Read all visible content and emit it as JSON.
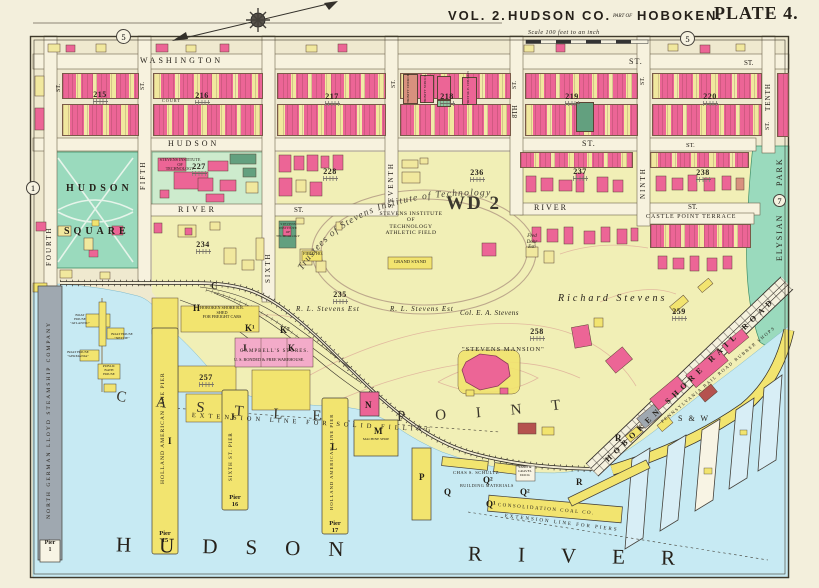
{
  "header": {
    "vol": "VOL. 2.",
    "county": "HUDSON CO.",
    "part_of": "PART OF",
    "city": "HOBOKEN.",
    "plate": "PLATE 4.",
    "scale": "Scale 100 feet to an inch"
  },
  "refs": {
    "top_left": "5",
    "top_right": "5",
    "left": "1",
    "right": "7"
  },
  "streets": {
    "washington": "WASHINGTON",
    "washington_st1": "ST.",
    "washington_st2": "ST.",
    "hudson": "HUDSON",
    "hudson_st1": "ST.",
    "hudson_st2": "ST.",
    "river_w": "RIVER",
    "river_w_st": "ST.",
    "river_e": "RIVER",
    "river_e_st": "ST.",
    "castle_point_terrace": "CASTLE POINT TERRACE",
    "fourth": "FOURTH",
    "fourth_st": "ST.",
    "fifth": "FIFTH",
    "fifth_st": "ST.",
    "sixth": "SIXTH",
    "seventh": "SEVENTH",
    "seventh_st": "ST.",
    "eighth": "8TH",
    "eighth_st": "ST.",
    "ninth": "NINTH",
    "ninth_st": "ST.",
    "tenth": "TENTH",
    "tenth_st": "ST.",
    "court": "COURT"
  },
  "areas": {
    "hudson_square_line1": "HUDSON",
    "hudson_square_line2": "SQUARE",
    "elysian": "ELYSIAN",
    "park": "PARK",
    "ward": "WD 2",
    "castle_point": "CASTLE POINT",
    "river_line1": "HUDSON",
    "river_line2": "RIVER"
  },
  "blocks": {
    "b215": "215",
    "b216": "216",
    "b217": "217",
    "b218": "218",
    "b219": "219",
    "b220": "220",
    "b227": "227",
    "b228": "228",
    "b234": "234",
    "b235": "235",
    "b236": "236",
    "b237": "237",
    "b238": "238",
    "b257": "257",
    "b258": "258",
    "b259": "259"
  },
  "stevens": {
    "campus": "STEVENS INSTITUTE\nOF\nTECHNOLOGY",
    "green_building": "STEVENS\nINSTITUTE\nOF\nTECHNOLOGY",
    "trustees": "Trustees of Stevens Institute of Technology",
    "athletic_field": "STEVENS INSTITUTE\nOF\nTECHNOLOGY\nATHLETIC FIELD",
    "grand_stand": "GRAND STAND",
    "field_house": "FIELD HO.",
    "mansion": "\"STEVENS MANSION\""
  },
  "estates": {
    "richard_stevens": "Richard Stevens",
    "rl_stevens_1": "R. L. Stevens Est",
    "rl_stevens_2": "R. L. Stevens Est",
    "col_stevens": "Col. E. A. Stevens",
    "fred_dohr": "Fred\nDohr\nEst."
  },
  "churches": {
    "trinity_church": "TRINITY CHURCH",
    "trinity_school": "TRINITY SCHOOL",
    "first_me": "FIRST M. E. CHURCH"
  },
  "railroads": {
    "hoboken_shore": "HOBOKEN SHORE RAIL ROAD",
    "pennsylvania": "PENNSYLVANIA RAIL ROAD RUBBER SHOPS",
    "sw": "S & W"
  },
  "waterfront": {
    "north_german_lloyd": "NORTH GERMAN LLOYD STEAMSHIP COMPANY",
    "pier_1": "Pier\n1",
    "holland_pier_i": "HOLLAND AMERICAN LINE PIER",
    "pier_15": "Pier\n15",
    "sixth_st_pier": "SIXTH ST. PIER",
    "pier_16": "Pier\n16",
    "holland_pier_l": "HOLLAND AMERICAN LINE PIER",
    "pier_17": "Pier\n17",
    "shed": "HOBOKEN SHORE R.R.\nSHED\nFOR FREIGHT CARS",
    "campbells": "CAMPBELL'S STORES.",
    "campbells_sub": "U. S. BONDED & FREE WAREHOUSE.",
    "machine_shop": "MACHINE SHOP",
    "schultz": "CHAS S. SCHULTZ",
    "building_materials": "BUILDING MATERIALS",
    "sand_gravel": "SAND &\nGRAVEL\nDOCK",
    "consolidation": "CONSOLIDATION COAL CO.",
    "extension_fill": "EXTENSION LINE FOR SOLID FILLING",
    "extension_piers": "EXTENSION LINE FOR PIERS",
    "boat_atlantic": "BOAT\nHOUSE\n\"ATLANTIC\"",
    "boat_nettie": "BOAT HOUSE\n\"NETTIE\"",
    "boat_germania": "BOAT HOUSE\n\"GERMANIA\"",
    "bath_house": "PUBLIC\nBATH\nHOUSE"
  },
  "letters": {
    "c": "C",
    "h": "H",
    "i": "I",
    "j_warehouse": "J",
    "j_pier": "J",
    "k": "K",
    "k1": "K¹",
    "k2": "K²",
    "l": "L",
    "m": "M",
    "n": "N",
    "p": "P",
    "q": "Q",
    "q1": "Q¹",
    "q2": "Q²",
    "q2b": "Q²",
    "r1": "R",
    "r2": "R"
  }
}
